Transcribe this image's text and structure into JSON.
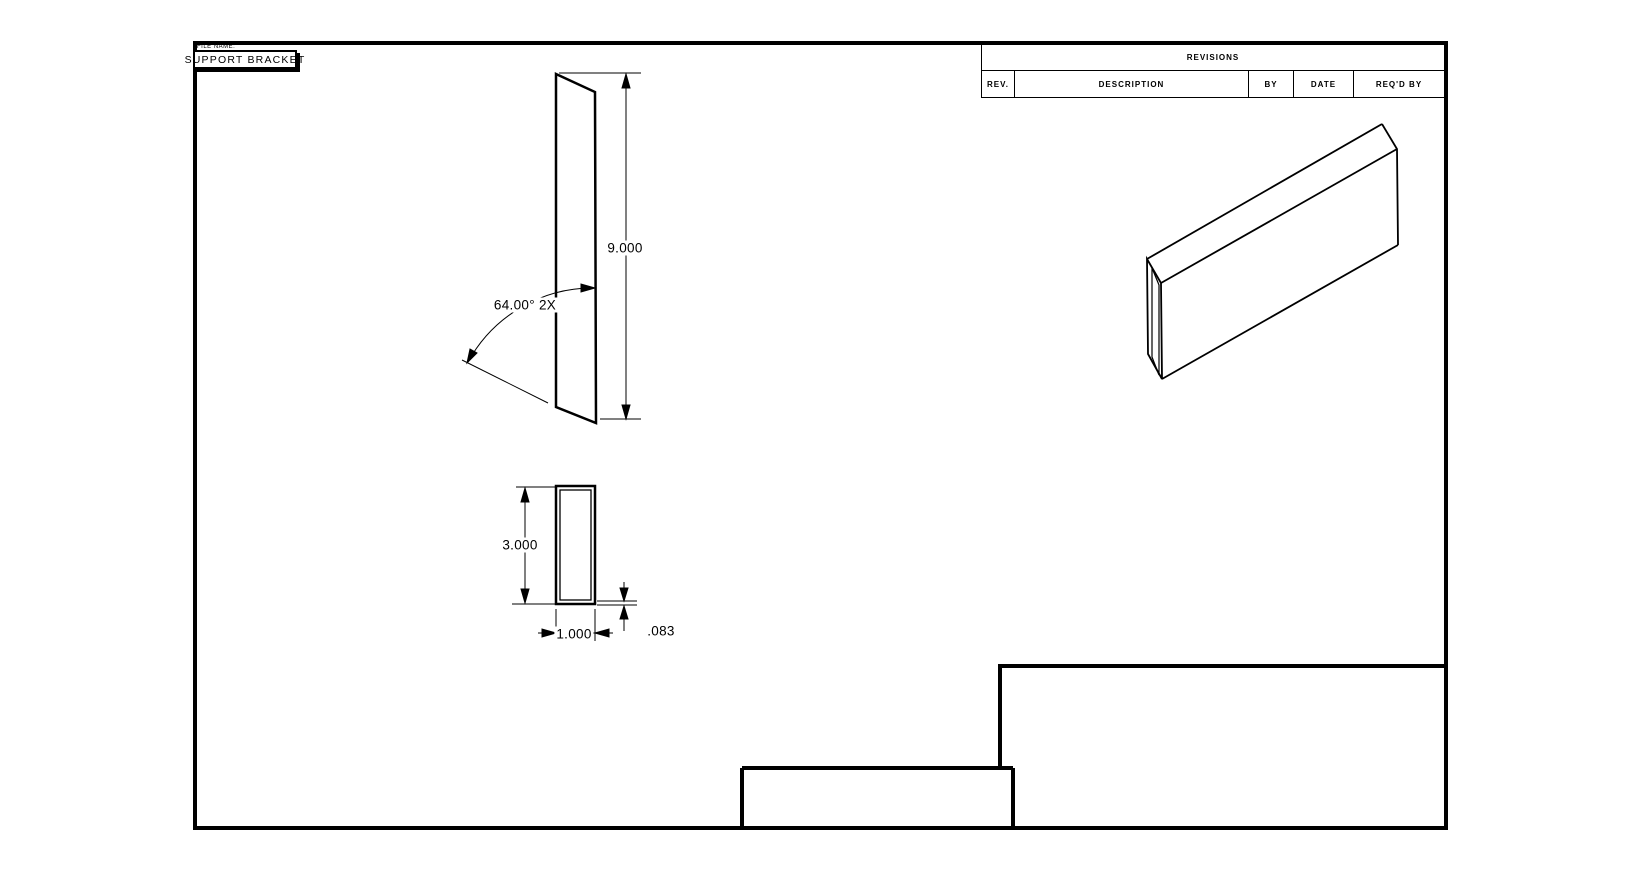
{
  "sheet": {
    "file_name_label": "FILE NAME:",
    "title": "SUPPORT BRACKET"
  },
  "revisions": {
    "title": "REVISIONS",
    "columns": {
      "rev": "REV.",
      "description": "DESCRIPTION",
      "by": "BY",
      "date": "DATE",
      "reqd_by": "REQ'D BY"
    }
  },
  "dimensions": {
    "front_height": "9.000",
    "bend_angle": "64.00° 2X",
    "profile_height": "3.000",
    "profile_width": "1.000",
    "wall_thickness": ".083"
  },
  "colors": {
    "line": "#000000",
    "background": "#ffffff"
  }
}
